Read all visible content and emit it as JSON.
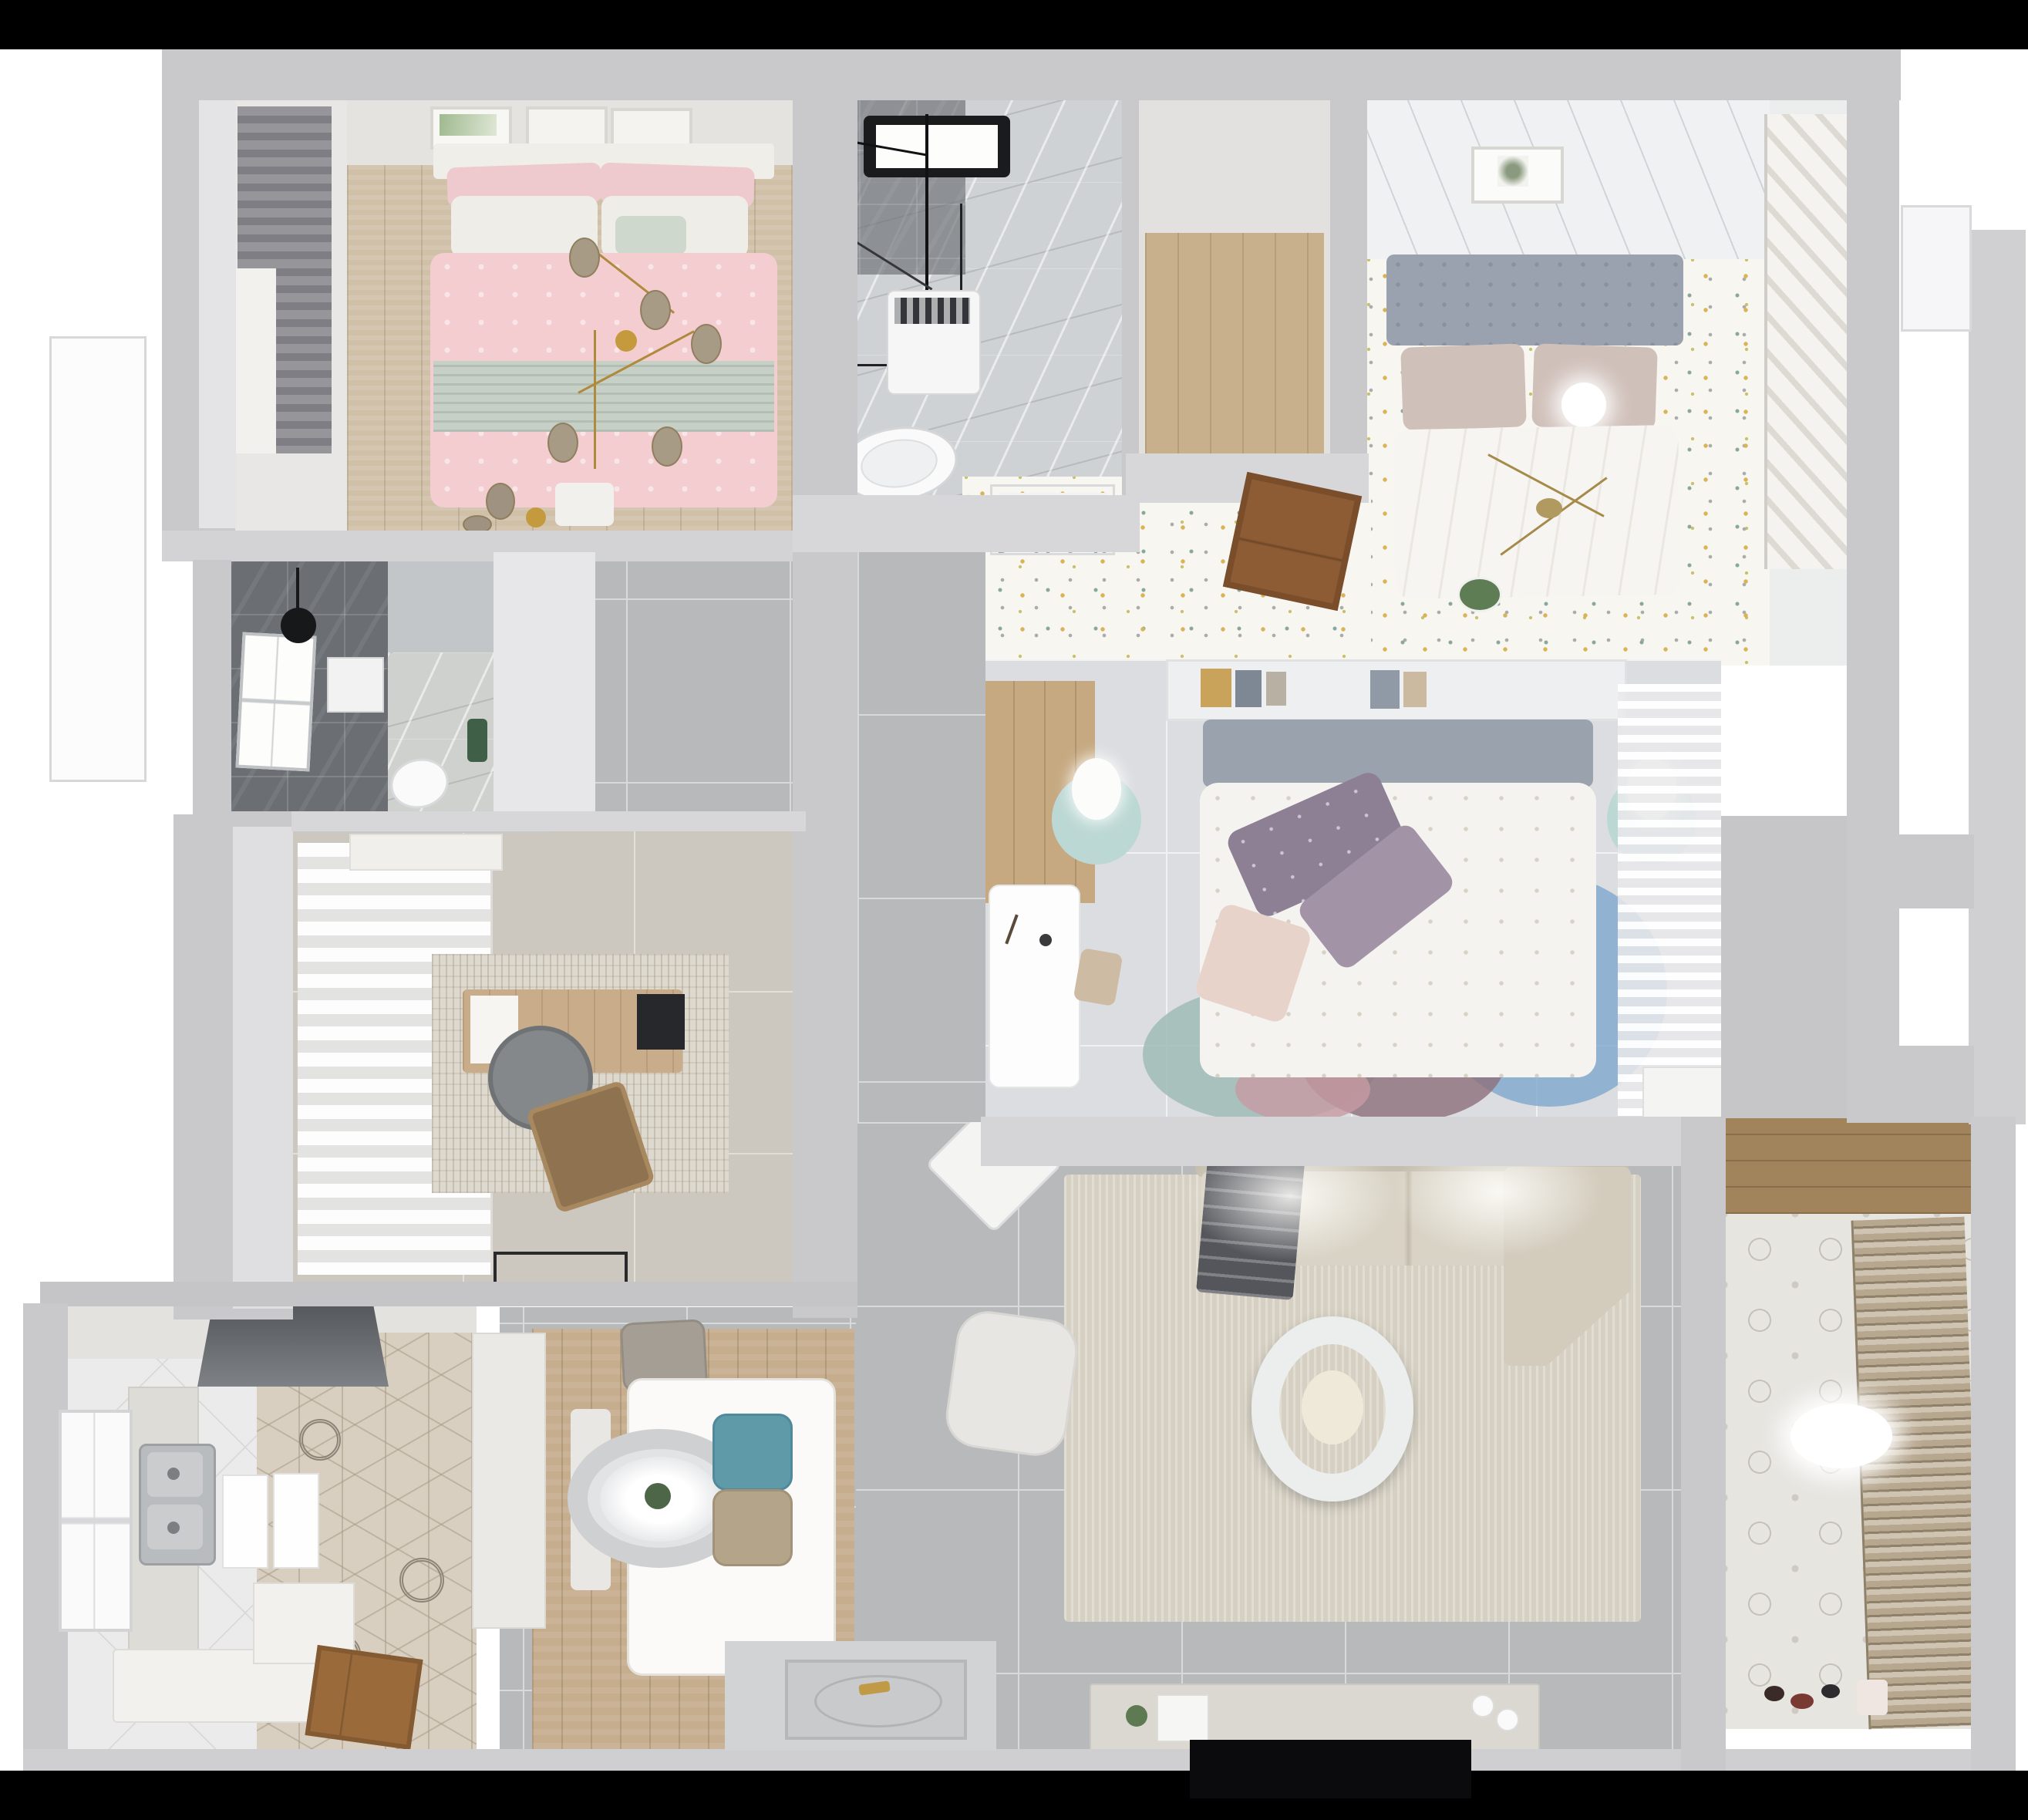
{
  "scene": {
    "title": "Top-down 3D render of an apartment floor plan",
    "type": "3d-floor-plan-render",
    "background_color": "#ffffff",
    "letterbox_band_color": "#000000"
  },
  "palette": {
    "wall": "#c9c9cb",
    "wall_light": "#d7d7d9",
    "corridor_tile": "#b8b9bb",
    "bedroom_tile": "#dcdde0",
    "study_tile": "#ccc8c0",
    "wood_floor": "#cfc0a7",
    "marble": "#ced2d5",
    "dark_tile": "#6b6f73",
    "confetti_floor": "#f8f6f1",
    "pink_bedding": "#f3cdd0",
    "sage_bedding": "#c7d0c6",
    "purple_pillow": "#8e8094",
    "teal_accent": "#5f9aa8",
    "mint_nightstand": "#bcd8d4",
    "rug_blue": "#7fa7cd",
    "rug_mauve": "#8d6f7b",
    "rug_teal": "#9fbcb6",
    "sofa_beige": "#d9d3c5",
    "door_wood": "#8d5c34",
    "gold_fixture": "#b08a3c",
    "tv_black": "#0b0b0d"
  },
  "rooms": [
    {
      "id": "bedroom-pink",
      "label": "Second bedroom",
      "furniture": [
        "double-bed-pink",
        "white-pillows",
        "sage-throw",
        "gold-branch-chandelier",
        "wall-art-frames",
        "gray-curtain",
        "foot-bench",
        "wood-floor"
      ]
    },
    {
      "id": "bathroom-main",
      "label": "Main bathroom",
      "furniture": [
        "skylight",
        "shower-fixture",
        "glass-screen",
        "washing-machine",
        "toilet",
        "marble-floor"
      ]
    },
    {
      "id": "entry-closet",
      "label": "Closet nook",
      "furniture": [
        "wood-floor"
      ]
    },
    {
      "id": "bedroom-master",
      "label": "Master bedroom",
      "furniture": [
        "double-bed-white",
        "gray-headboard",
        "taupe-pillows",
        "pendant-sphere-lamp",
        "gold-chandelier",
        "slatted-wardrobe",
        "picture-frame",
        "confetti-rug-floor",
        "ceiling-panels"
      ]
    },
    {
      "id": "hallway",
      "label": "Hallway",
      "furniture": [
        "ac-vent",
        "open-wood-door",
        "confetti-rug-floor",
        "ledge-plant"
      ]
    },
    {
      "id": "bedroom-center",
      "label": "Third bedroom",
      "furniture": [
        "bed-floral-duvet",
        "purple-pillows",
        "headboard-shelf-books",
        "mint-nightstands",
        "white-lamps",
        "white-desk",
        "stool",
        "circle-rug",
        "sheer-curtain",
        "wardrobe-wood-strip",
        "bench"
      ]
    },
    {
      "id": "living-room",
      "label": "Living room",
      "furniture": [
        "l-shaped-sofa",
        "dark-throw-blanket",
        "round-coffee-table",
        "white-armchair",
        "diamond-side-table",
        "tv-console",
        "tv-panel",
        "area-rug"
      ]
    },
    {
      "id": "dining-room",
      "label": "Dining area",
      "furniture": [
        "dining-table",
        "gray-chair",
        "teal-chair",
        "beige-chair",
        "bench",
        "ring-pendant-lamp",
        "plank-rug"
      ]
    },
    {
      "id": "kitchen",
      "label": "Kitchen",
      "furniture": [
        "range-hood",
        "double-sink",
        "counters",
        "tall-cabinet",
        "open-wood-door",
        "hex-tile-floor",
        "window"
      ]
    },
    {
      "id": "study",
      "label": "Study",
      "furniture": [
        "desk",
        "monitor",
        "desk-chair",
        "lounge-chair",
        "sideboard",
        "distressed-rug",
        "curtain-wall",
        "doormat"
      ]
    },
    {
      "id": "bathroom-dark",
      "label": "Shower room",
      "furniture": [
        "window",
        "rain-shower",
        "mirror",
        "toilet",
        "plant",
        "mosaic-floor"
      ]
    },
    {
      "id": "balcony",
      "label": "Balcony / laundry",
      "furniture": [
        "louvered-blinds",
        "wood-shelf",
        "ceiling-light",
        "floor-toys",
        "patterned-tile-floor"
      ]
    }
  ]
}
